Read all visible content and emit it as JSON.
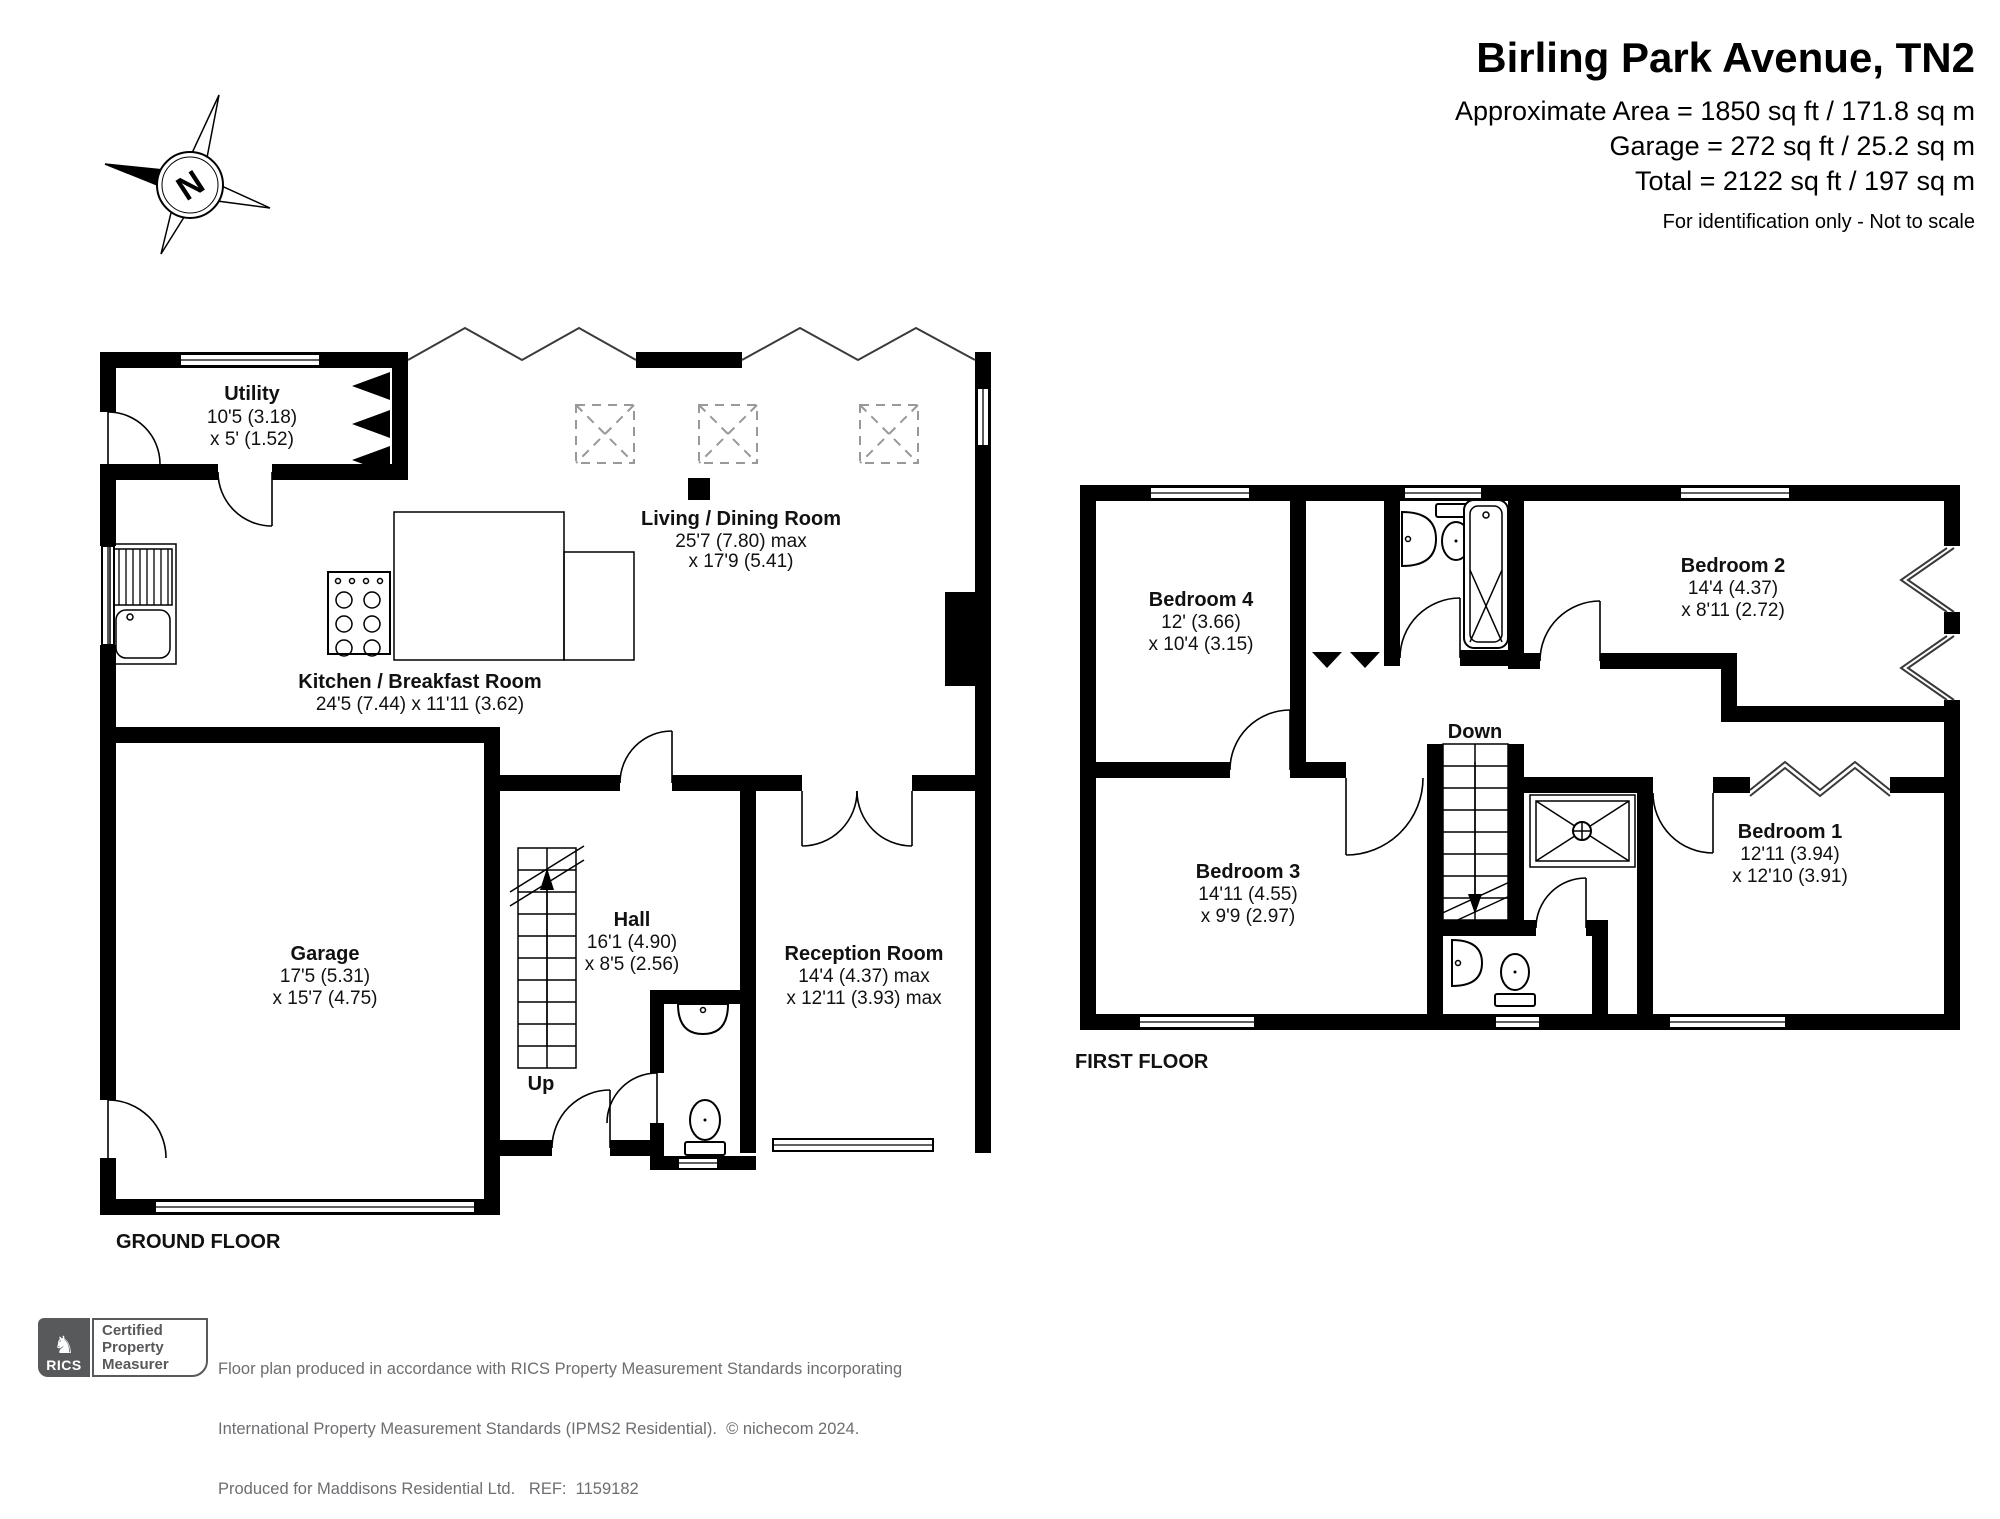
{
  "header": {
    "title": "Birling Park Avenue, TN2",
    "area_line1": "Approximate Area = 1850 sq ft / 171.8 sq m",
    "area_line2": "Garage = 272 sq ft / 25.2 sq m",
    "area_line3": "Total = 2122 sq ft / 197 sq m",
    "note": "For identification only - Not to scale"
  },
  "compass": {
    "label": "N"
  },
  "ground_floor": {
    "label": "GROUND FLOOR",
    "stairs_label": "Up",
    "rooms": {
      "utility": [
        "Utility",
        "10'5 (3.18)",
        "x 5' (1.52)"
      ],
      "living": [
        "Living / Dining Room",
        "25'7 (7.80) max",
        "x 17'9 (5.41)"
      ],
      "kitchen": [
        "Kitchen / Breakfast Room",
        "24'5 (7.44) x 11'11 (3.62)"
      ],
      "garage": [
        "Garage",
        "17'5 (5.31)",
        "x 15'7 (4.75)"
      ],
      "hall": [
        "Hall",
        "16'1 (4.90)",
        "x 8'5 (2.56)"
      ],
      "reception": [
        "Reception Room",
        "14'4 (4.37) max",
        "x 12'11 (3.93) max"
      ]
    }
  },
  "first_floor": {
    "label": "FIRST FLOOR",
    "stairs_label": "Down",
    "rooms": {
      "bedroom1": [
        "Bedroom 1",
        "12'11 (3.94)",
        "x 12'10 (3.91)"
      ],
      "bedroom2": [
        "Bedroom 2",
        "14'4 (4.37)",
        "x 8'11 (2.72)"
      ],
      "bedroom3": [
        "Bedroom 3",
        "14'11 (4.55)",
        "x 9'9 (2.97)"
      ],
      "bedroom4": [
        "Bedroom 4",
        "12' (3.66)",
        "x 10'4 (3.15)"
      ]
    }
  },
  "footer": {
    "rics_label": "RICS",
    "cert_line1": "Certified",
    "cert_line2": "Property",
    "cert_line3": "Measurer",
    "line1": "Floor plan produced in accordance with RICS Property Measurement Standards incorporating",
    "line2": "International Property Measurement Standards (IPMS2 Residential).  © nichecom 2024.",
    "line3": "Produced for Maddisons Residential Ltd.   REF:  1159182"
  }
}
